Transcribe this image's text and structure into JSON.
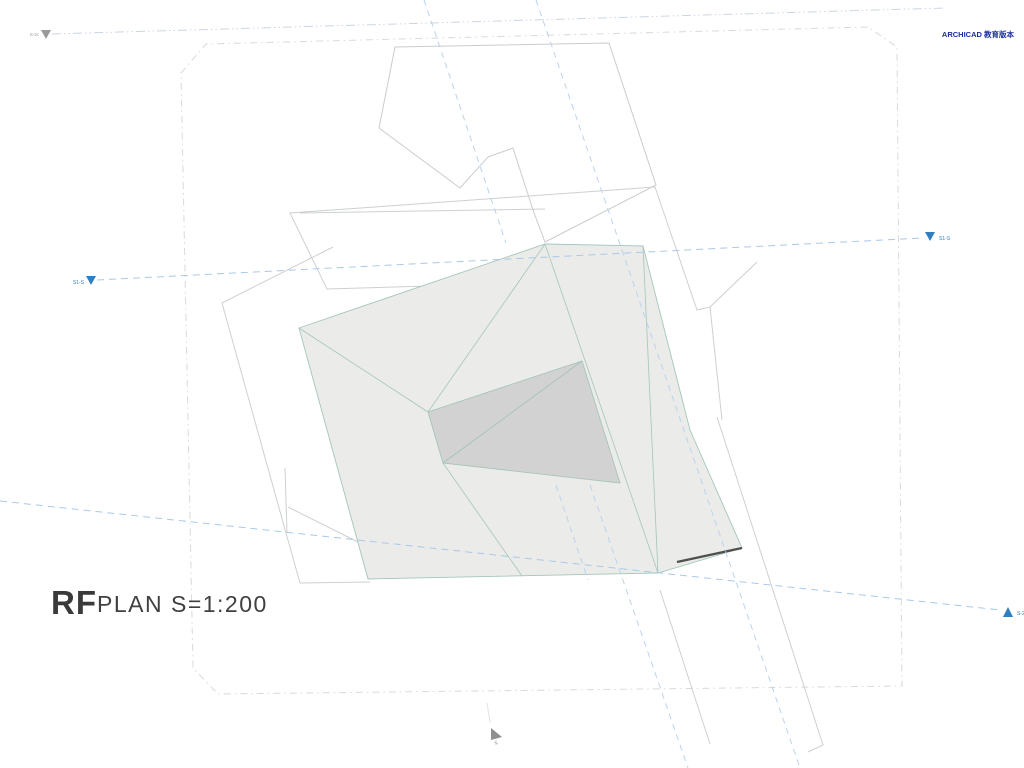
{
  "app": {
    "watermark": "ARCHICAD 教育版本"
  },
  "title": {
    "drawing_name": "RF",
    "scale_label": "PLAN S=1:200"
  },
  "markers": {
    "top_left": {
      "label": "S-2c",
      "direction": "down",
      "color": "#9a9a9a"
    },
    "section1_left": {
      "label": "S1-S",
      "direction": "down",
      "color": "#2f7fc1"
    },
    "section1_right": {
      "label": "S1-S",
      "direction": "down",
      "color": "#2f7fc1"
    },
    "section2_right": {
      "label": "S-2",
      "direction": "up",
      "color": "#2f7fc1"
    }
  },
  "colors": {
    "accent_blue": "#2f7fc1",
    "section_dash_blue": "#a9c9e9",
    "guide_dash_blue": "#b9d4ee",
    "boundary_gray": "#d7dbd7",
    "outline_gray": "#c9ccce",
    "roof_fill": "#ebebe9",
    "opening_fill": "#d2d2d3",
    "roof_edge_teal": "#a5c6ba",
    "watermark_navy": "#1b2d9b",
    "title_gray": "#3a3a3a"
  }
}
